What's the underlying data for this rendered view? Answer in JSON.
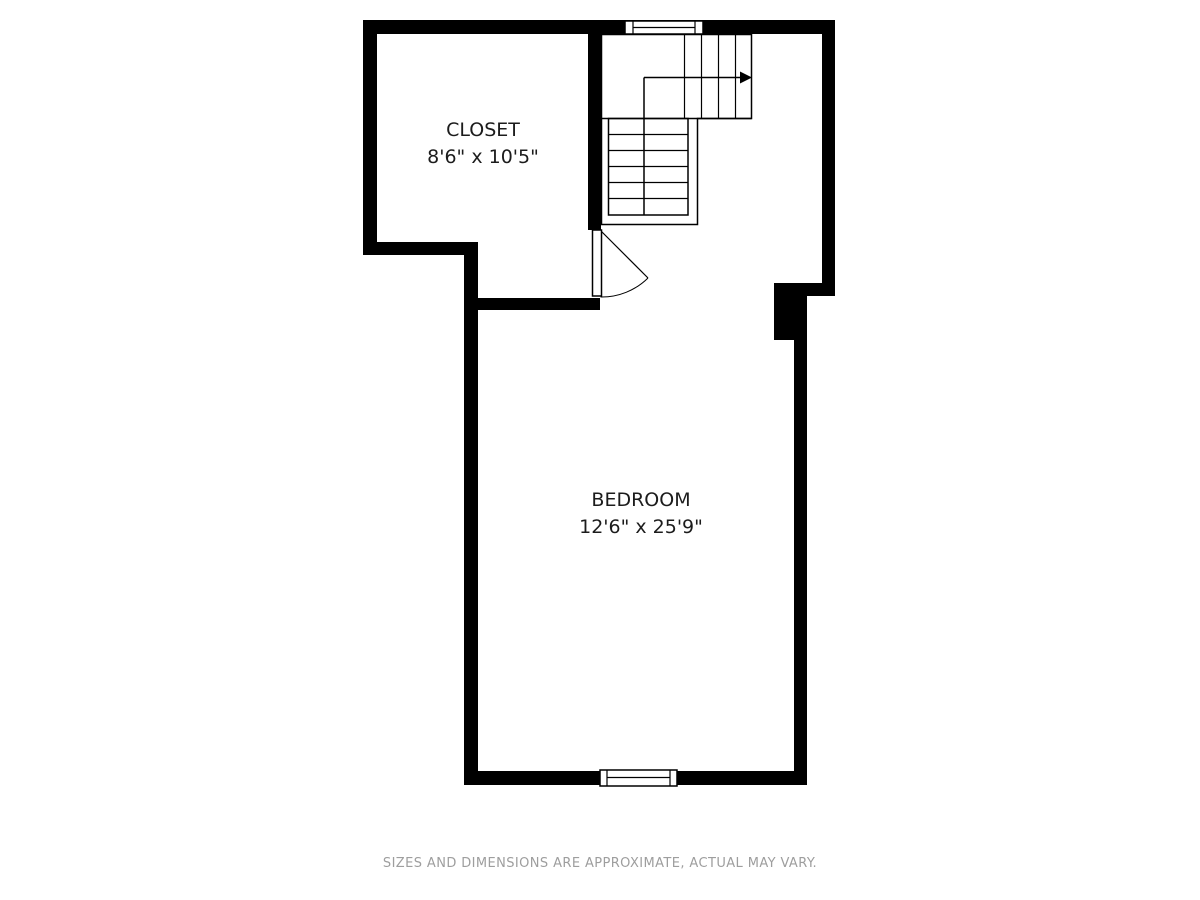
{
  "plan": {
    "type": "floor-plan",
    "rooms": [
      {
        "name": "CLOSET",
        "dimensions": "8'6\" x 10'5\""
      },
      {
        "name": "BEDROOM",
        "dimensions": "12'6\" x 25'9\""
      }
    ],
    "stairs": {
      "direction": "up",
      "arrow": "right"
    },
    "features": [
      "window-top",
      "window-bottom",
      "closet-door",
      "l-shaped-staircase"
    ]
  },
  "footer": {
    "disclaimer": "SIZES AND DIMENSIONS ARE APPROXIMATE, ACTUAL MAY VARY."
  },
  "colors": {
    "wall": "#000000",
    "line": "#000000",
    "background": "#ffffff",
    "disclaimer_text": "#9e9e9e"
  }
}
